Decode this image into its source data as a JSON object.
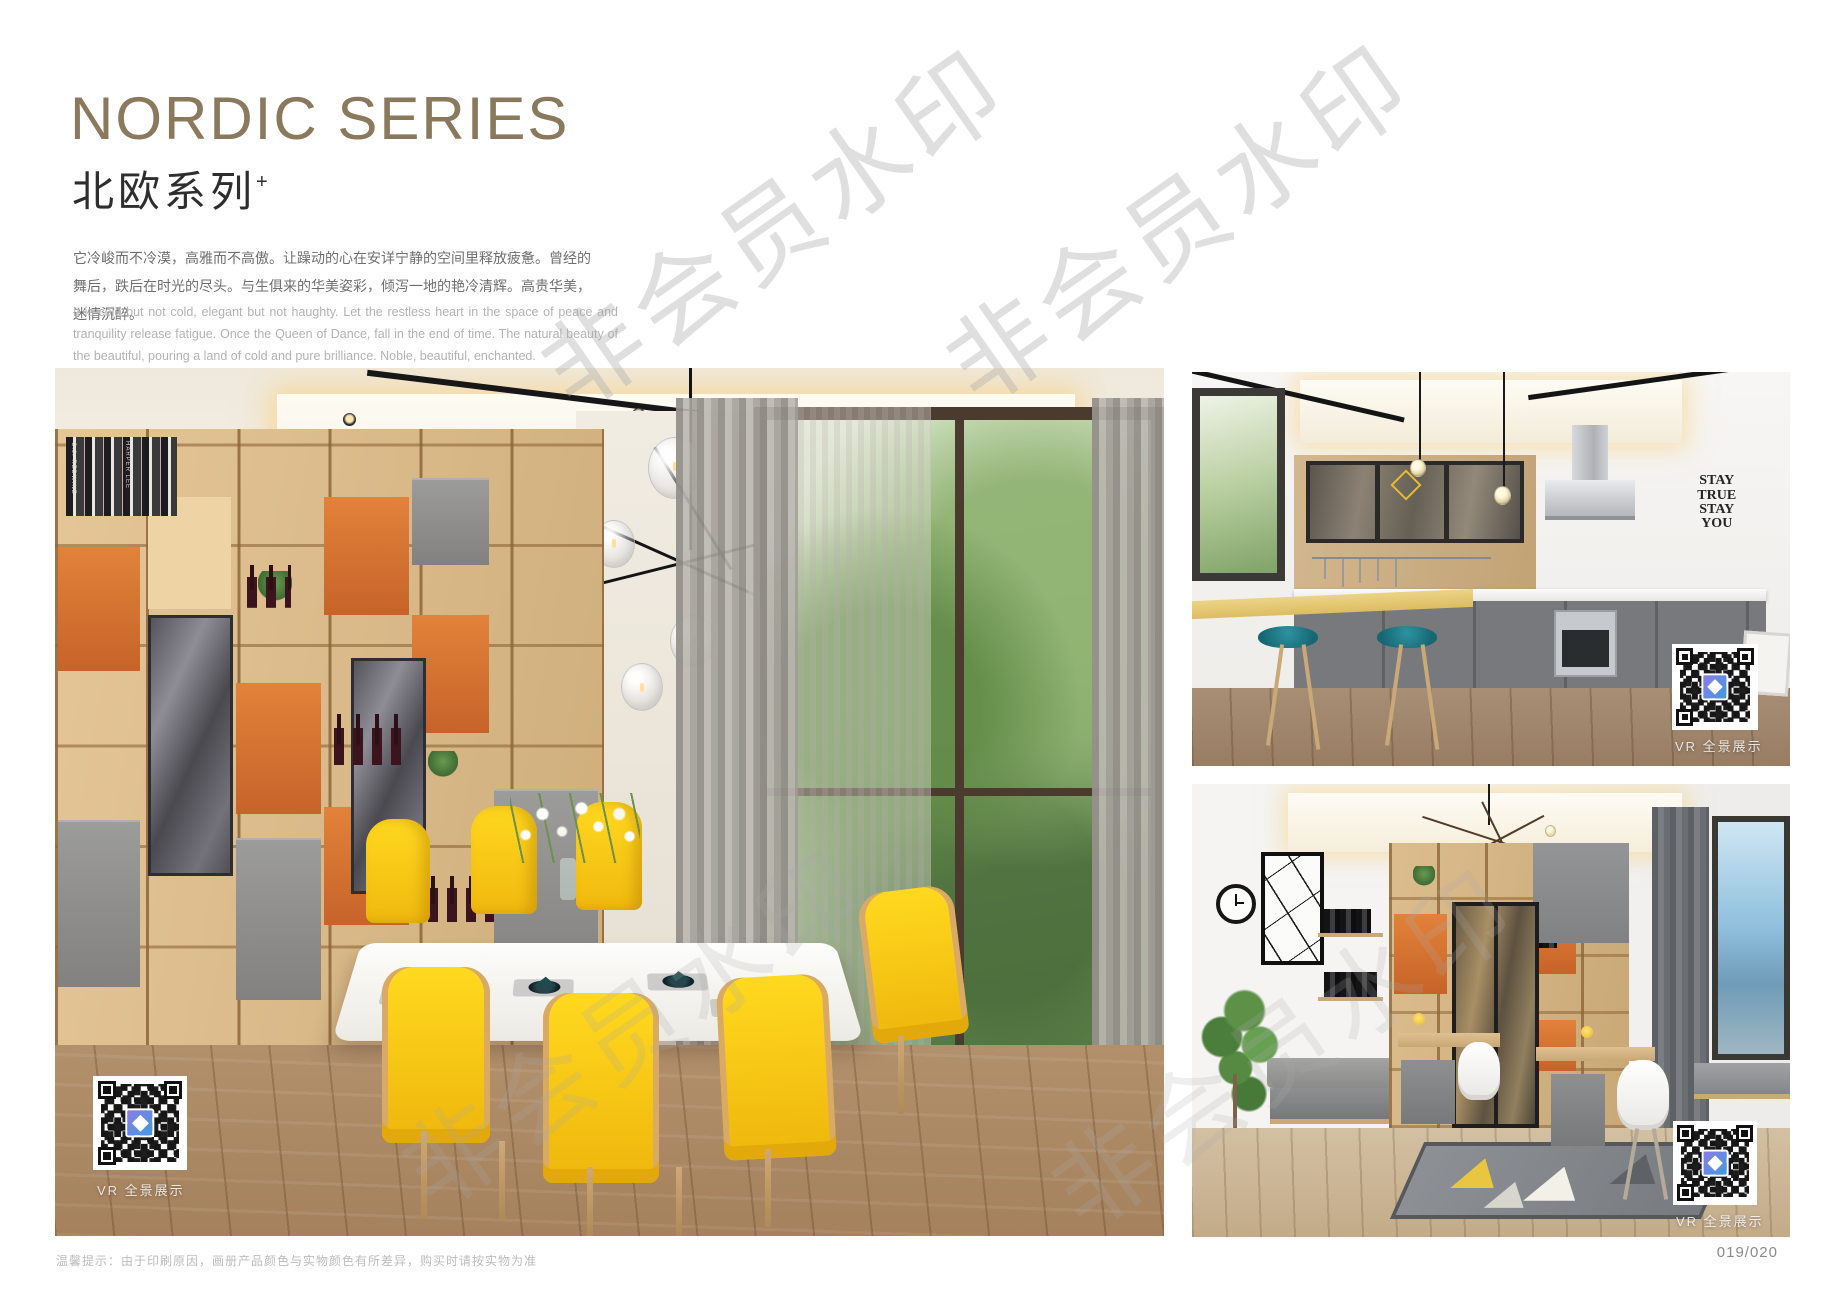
{
  "header": {
    "title": "NORDIC SERIES",
    "subtitle": "北欧系列",
    "subtitle_sup": "+",
    "desc_cn": "它冷峻而不冷漠，高雅而不高傲。让躁动的心在安详宁静的空间里释放疲惫。曾经的舞后，跌后在时光的尽头。与生俱来的华美姿彩，倾泻一地的艳冷清辉。高贵华美，迷情沉醉。",
    "desc_en": "It is cold but not cold, elegant but not haughty. Let the restless heart in the space of peace and tranquility release fatigue. Once the Queen of Dance, fall in the end of time. The natural beauty of the beautiful, pouring a land of cold and pure brilliance. Noble, beautiful, enchanted."
  },
  "watermark": {
    "text": "非会员水印"
  },
  "images": {
    "dining": {
      "vr_label": "VR 全景展示",
      "book_spine_1": "C.J. REDWINE",
      "book_spine_2": "HARPER LEE"
    },
    "kitchen": {
      "vr_label": "VR 全景展示",
      "wall_art": {
        "line1": "STAY",
        "line2": "TRUE",
        "line3": "STAY",
        "line4": "YOU"
      }
    },
    "study": {
      "vr_label": "VR 全景展示"
    }
  },
  "footer": {
    "note": "温馨提示：由于印刷原因，画册产品颜色与实物颜色有所差异，购买时请按实物为准",
    "page_number": "019/020"
  },
  "colors": {
    "accent_bronze": "#8a795d",
    "chair_yellow": "#f6c51c",
    "stool_teal": "#20808d",
    "shelf_orange": "#d9742f",
    "qr_logo_blue": "#3f9be0"
  }
}
